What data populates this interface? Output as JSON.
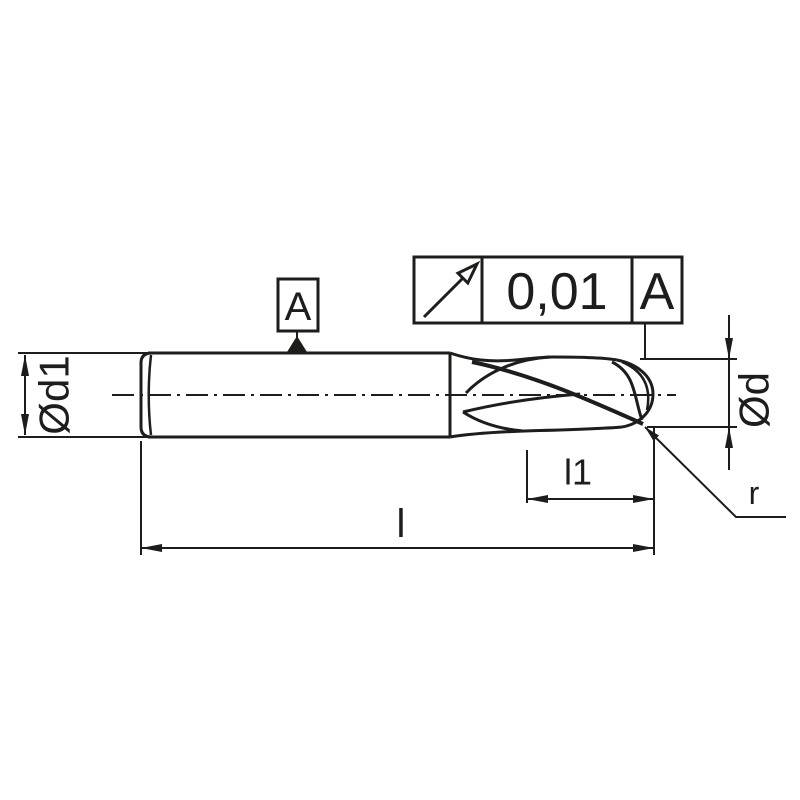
{
  "page": {
    "background": "#ffffff",
    "line_color": "#1d1d1b"
  },
  "drawing": {
    "dimension_labels": {
      "shank_diameter": "Ød1",
      "cutting_diameter": "Ød",
      "flute_length": "l1",
      "overall_length": "l",
      "corner_radius": "r"
    },
    "datum": {
      "letter": "A"
    },
    "tolerance_frame": {
      "symbol_icon": "circular-runout-icon",
      "value": "0,01",
      "datum_reference": "A"
    }
  }
}
